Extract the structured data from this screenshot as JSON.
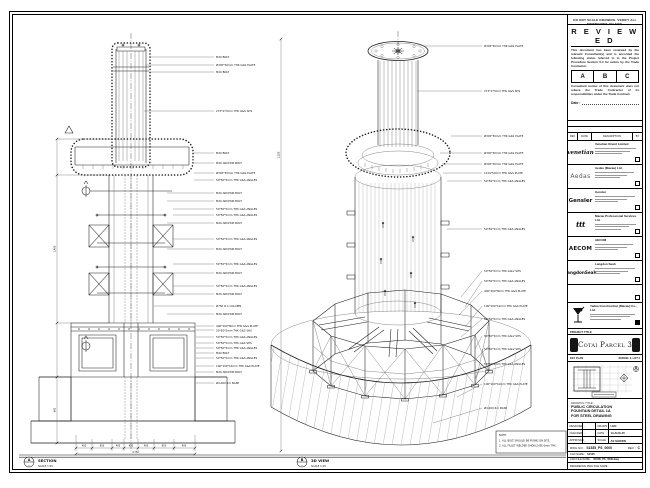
{
  "sheet": {
    "top_note": "DO NOT SCALE DRAWING. VERIFY ALL DIMENSIONS ON SITE."
  },
  "review_stamp": {
    "title": "R E V I E W E D",
    "body1": "This document has been reviewed by the relevant Consultant(s) and is accorded the following status referred to in the Project Procedure Section 5.4 for action by the Trade Contractor.",
    "options": [
      "A",
      "B",
      "C"
    ],
    "body2": "Consultant review of this document does not relieve the Trade Contractor of its responsibilities under the Trade Contract.",
    "date_label": "Date :"
  },
  "revision_header": {
    "cols": [
      "REV",
      "DATE",
      "DESCRIPTION",
      "BY"
    ]
  },
  "consultants": [
    {
      "logo": "venetian",
      "name": "Venetian Orient Limited"
    },
    {
      "logo": "Aedas",
      "name": "Aedas (Macau) Ltd."
    },
    {
      "logo": "Gensler",
      "name": "Gensler"
    },
    {
      "logo": "ttt",
      "name": "Macau Professional Services Ltd."
    },
    {
      "logo": "AECOM",
      "name": "AECOM"
    },
    {
      "logo": "LangdonSeah",
      "name": "Langdon Seah"
    }
  ],
  "contractor": {
    "name": "Yadea Construction (Macau) Co., Ltd."
  },
  "project": {
    "label": "PROJECT TITLE",
    "title": "Cotai Parcel 3"
  },
  "key_plan": {
    "label": "KEY PLAN",
    "right_label": "PARCEL 3, LOT 2"
  },
  "drawing_title": {
    "label": "DRAWING TITLE :",
    "line1": "PUBLIC CIRCULATION",
    "line2": "FOUNTAIN DETAIL 1A",
    "line3": "FOR STEEL DRAWING"
  },
  "info_table": {
    "designed_label": "DESIGNED",
    "designed": "-",
    "drawn_label": "DRAWN",
    "drawn": "LHO",
    "checked_label": "CHECKED",
    "checked": "-",
    "date_label": "DATE",
    "date": "14-AUG-15",
    "approved_label": "APPROVED",
    "approved": "-",
    "scale_label": "SCALE",
    "scale": "AS SHOWN"
  },
  "doc_numbers": {
    "dwg_label": "DWG NO :",
    "dwg_no": "S1535_PS_0000",
    "rev_label": "REV :",
    "rev": "C",
    "cad_name_label": "CAD NAME :",
    "cad_name": "S1535",
    "cad_file_label": "CAD FILE NAME :",
    "cad_file": "S1535_PS_0000.dwg",
    "ref_label": "REFERENCE DWG FILE NAME :"
  },
  "views": {
    "section": {
      "bubble": "A",
      "name": "SECTION",
      "scale": "SCALE 1:25"
    },
    "iso": {
      "bubble": "B",
      "name": "3D VIEW",
      "scale": "SCALE 1:25"
    }
  },
  "notes": {
    "title": "NOTE:",
    "line1": "1. ALL BOLT SHOULD BE FIXING ON SITE.",
    "line2": "2. ALL FILLET WELDED SHOULD BE 6mm THK."
  },
  "section_labels": [
    "M20 BOLT",
    "Ø345*50mm THK G&S PLATE",
    "M20 BOLT",
    "273*273mm THK G&S SHS",
    "M20 BOLT",
    "M20 ANCHOR BOLT",
    "Ø345*50mm THK G&S PLATE",
    "50*50*5mm THK G&S ANGLES",
    "M20 ANCHOR BOLT",
    "M20 ANCHOR BOLT",
    "50*50*5mm THK G&S ANGLES",
    "50*50*5mm THK G&S ANGLES",
    "M20 ANCHOR BOLT",
    "50*50*5mm THK G&S ANGLES",
    "M20 ANCHOR BOLT",
    "50*50*5mm THK G&S ANGLES",
    "M20 ANCHOR BOLT",
    "50*50*5mm THK G&S ANGLES",
    "M20 ANCHOR BOLT",
    "Ø750 R.C COLUMN",
    "M20 ANCHOR BOLT",
    "400*200*8mm THK G&S PLATE",
    "50*50*5mm THK G&S SHS",
    "50*50*5mm THK G&S ANGLES",
    "50*50*5mm THK G&S SHS",
    "50*50*5mm THK G&S ANGLES",
    "M20 BOLT",
    "50*50*5mm THK G&S ANGLES",
    "100*100*10mm THK G&S PLATE",
    "M20 ANCHOR BOLT",
    "Ø4,000 R.C BASE"
  ],
  "iso_labels": [
    "Ø345*50mm THK G&S PLATE",
    "273*273mm THK G&S SHS",
    "Ø345*50mm THK G&S PLATE",
    "Ø345*50mm THK G&S PLATE",
    "Ø345*50mm THK G&S PLATE",
    "1219*50mm THK G&S PLATE",
    "50*50*5mm THK G&S ANGLES",
    "50*50*5mm THK G&S ANGLES",
    "50*50*5mm THK GALV SHS",
    "50*50*5mm THK G&S ANGLES",
    "400*200*8mm THK G&S PLATE",
    "100*100*10mm THK G&S PLATE",
    "50*50*5mm THK G&S ANGLES",
    "50*50*5mm THK GALV SHS",
    "50*50*5mm THK GALV SHS",
    "50*50*5mm THK G&S ANGLES",
    "100*100*10mm THK G&S PLATE",
    "Ø4,000 R.C BASE"
  ],
  "dims": {
    "bottom_segments": [
      "400",
      "850",
      "400",
      "450",
      "400",
      "850",
      "400"
    ],
    "bottom_total": "3,750",
    "left_upper": "1,480",
    "left_lower": "660",
    "right_total": "2,280"
  }
}
